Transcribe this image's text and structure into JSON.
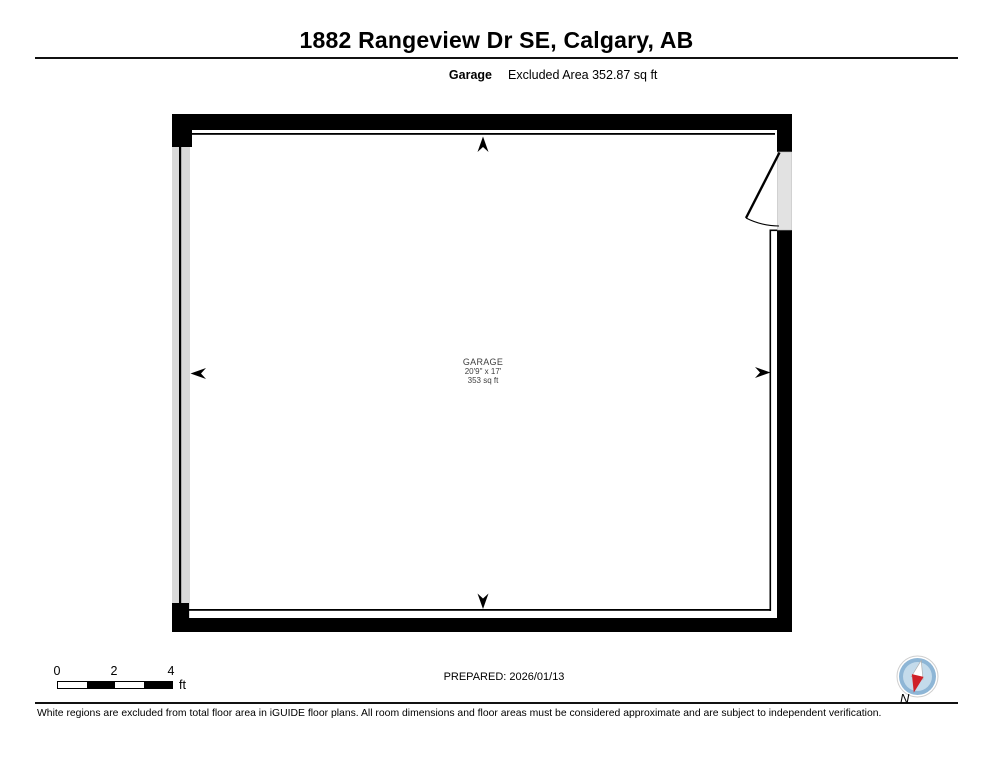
{
  "header": {
    "title": "1882 Rangeview Dr SE, Calgary, AB",
    "floor_label": "Garage",
    "area_note": "Excluded Area 352.87 sq ft"
  },
  "floorplan": {
    "room": {
      "name": "GARAGE",
      "dimensions": "20'9\" x 17'",
      "area": "353 sq ft"
    }
  },
  "scale_bar": {
    "ticks": [
      "0",
      "2",
      "4"
    ],
    "unit": "ft"
  },
  "footer": {
    "prepared": "PREPARED: 2026/01/13",
    "compass_label": "N",
    "disclaimer": "White regions are excluded from total floor area in iGUIDE floor plans. All room dimensions and floor areas must be considered approximate and are subject to independent verification."
  },
  "colors": {
    "wall_black": "#000000",
    "excluded_gray": "#d9d9d9",
    "door_gray": "#e2e2e2",
    "compass_ring_blue": "#8eb6d6",
    "compass_inner_blue": "#c4dbeb",
    "compass_needle_red": "#cf2027"
  }
}
